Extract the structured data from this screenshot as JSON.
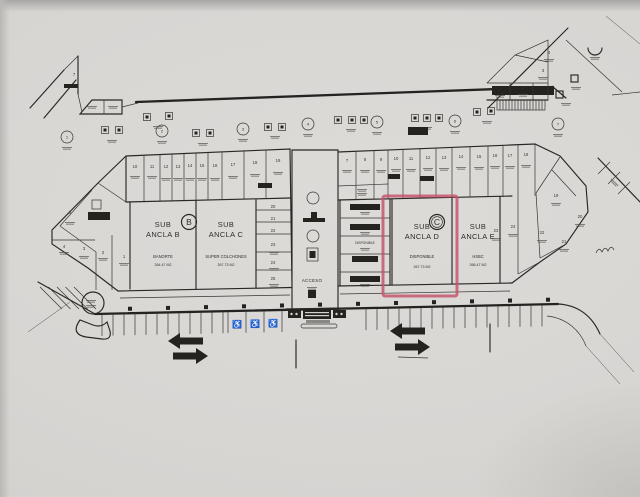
{
  "plan": {
    "anchors": [
      {
        "line1": "SUB",
        "line2": "ANCLA B",
        "tenant": "BANORTE",
        "area": "264.47 M2"
      },
      {
        "line1": "SUB",
        "line2": "ANCLA C",
        "tenant": "SUPER COLCHONES",
        "area": "267.73 M2"
      },
      {
        "line1": "SUB",
        "line2": "ANCLA D",
        "tenant": "DISPONIBLE",
        "area": "267.73 M2"
      },
      {
        "line1": "SUB",
        "line2": "ANCLA E",
        "tenant": "HSBC",
        "area": "266.47 M2"
      }
    ],
    "section_markers": [
      {
        "label": "B",
        "x": 189,
        "y": 222
      },
      {
        "label": "C",
        "x": 437,
        "y": 222
      }
    ],
    "corridor_label": "ACCESO",
    "available_label": "DISPONIBLE",
    "highlight_color": "#c8506b",
    "icons": {
      "wheelchair": "♿"
    },
    "unit_numbers": [
      {
        "t": "10",
        "x": 135,
        "y": 168
      },
      {
        "t": "11",
        "x": 152,
        "y": 168
      },
      {
        "t": "12",
        "x": 166,
        "y": 168
      },
      {
        "t": "13",
        "x": 178,
        "y": 168
      },
      {
        "t": "14",
        "x": 190,
        "y": 167
      },
      {
        "t": "15",
        "x": 202,
        "y": 167
      },
      {
        "t": "16",
        "x": 215,
        "y": 167
      },
      {
        "t": "17",
        "x": 233,
        "y": 166
      },
      {
        "t": "18",
        "x": 255,
        "y": 164
      },
      {
        "t": "19",
        "x": 278,
        "y": 162
      },
      {
        "t": "20",
        "x": 273,
        "y": 208
      },
      {
        "t": "21",
        "x": 273,
        "y": 220
      },
      {
        "t": "22",
        "x": 273,
        "y": 232
      },
      {
        "t": "23",
        "x": 273,
        "y": 246
      },
      {
        "t": "24",
        "x": 273,
        "y": 264
      },
      {
        "t": "25",
        "x": 273,
        "y": 280
      },
      {
        "t": "7",
        "x": 347,
        "y": 162
      },
      {
        "t": "8",
        "x": 365,
        "y": 161
      },
      {
        "t": "9",
        "x": 381,
        "y": 161
      },
      {
        "t": "10",
        "x": 396,
        "y": 160
      },
      {
        "t": "11",
        "x": 411,
        "y": 160
      },
      {
        "t": "12",
        "x": 428,
        "y": 159
      },
      {
        "t": "13",
        "x": 444,
        "y": 159
      },
      {
        "t": "14",
        "x": 461,
        "y": 158
      },
      {
        "t": "15",
        "x": 479,
        "y": 158
      },
      {
        "t": "16",
        "x": 495,
        "y": 157
      },
      {
        "t": "17",
        "x": 510,
        "y": 157
      },
      {
        "t": "18",
        "x": 526,
        "y": 156
      },
      {
        "t": "19",
        "x": 556,
        "y": 197
      },
      {
        "t": "20",
        "x": 580,
        "y": 218
      },
      {
        "t": "21",
        "x": 564,
        "y": 243
      },
      {
        "t": "22",
        "x": 542,
        "y": 234
      },
      {
        "t": "23",
        "x": 496,
        "y": 232
      },
      {
        "t": "24",
        "x": 513,
        "y": 228
      },
      {
        "t": "5",
        "x": 70,
        "y": 214
      },
      {
        "t": "4",
        "x": 64,
        "y": 248
      },
      {
        "t": "3",
        "x": 84,
        "y": 250
      },
      {
        "t": "2",
        "x": 103,
        "y": 254
      },
      {
        "t": "1",
        "x": 124,
        "y": 258
      },
      {
        "t": "7",
        "x": 74,
        "y": 76
      },
      {
        "t": "1",
        "x": 500,
        "y": 90
      },
      {
        "t": "2",
        "x": 523,
        "y": 89
      },
      {
        "t": "3",
        "x": 543,
        "y": 72
      },
      {
        "t": "4",
        "x": 549,
        "y": 54
      }
    ],
    "axis_markers": [
      {
        "t": "1",
        "x": 67,
        "y": 137
      },
      {
        "t": "2",
        "x": 162,
        "y": 131
      },
      {
        "t": "3",
        "x": 243,
        "y": 129
      },
      {
        "t": "4",
        "x": 308,
        "y": 124
      },
      {
        "t": "5",
        "x": 377,
        "y": 122
      },
      {
        "t": "6",
        "x": 455,
        "y": 121
      },
      {
        "t": "7",
        "x": 558,
        "y": 124
      }
    ]
  }
}
